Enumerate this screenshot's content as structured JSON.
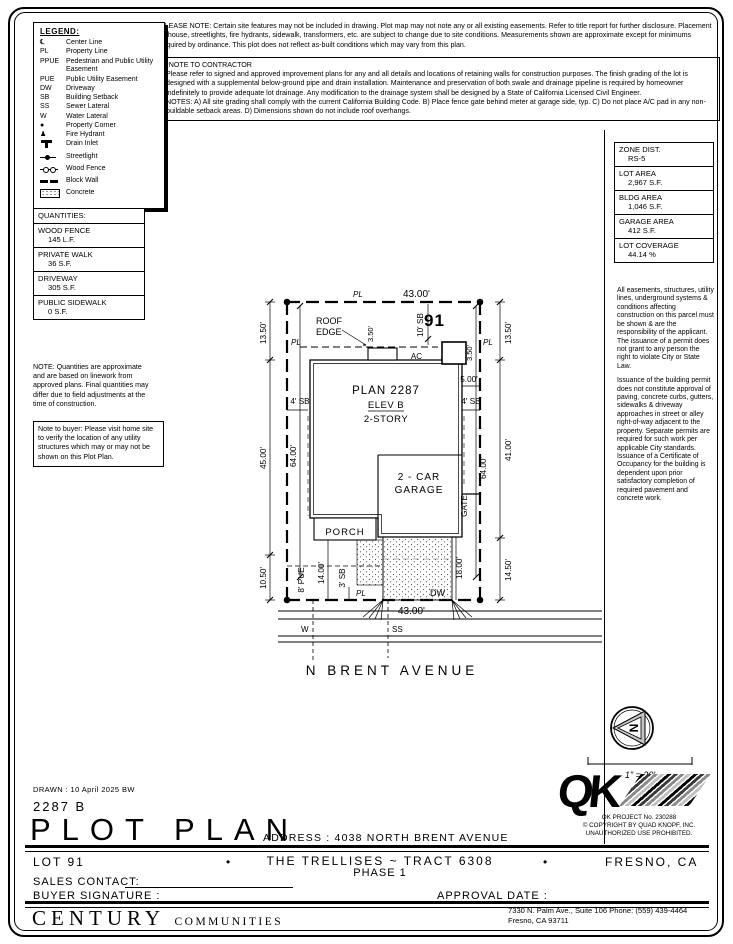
{
  "notes": {
    "please_note": "PLEASE NOTE:  Certain site features may not be included in drawing.  Plot map may not note any or all existing easements.  Refer to title report for further disclosure.  Placement of house, streetlights, fire hydrants, sidewalk, transformers, etc. are subject to change due to site conditions.  Measurements shown are approximate except for minimums required by ordinance.  This plot does not reflect as-built conditions which may vary from this plan.",
    "contractor_title": "*NOTE TO CONTRACTOR",
    "contractor_body": "Please refer to signed and approved improvement plans for any and all details and locations of retaining walls for construction purposes.  The finish grading of the lot is designed with a supplemental below-ground pipe and drain installation.  Maintenance and preservation of both swale and drainage pipeline is required by homeowner indefinitely to provide adequate lot drainage.  Any modification to the drainage system shall be designed by a State of California Licensed Civil Engineer.",
    "contractor_notes": "NOTES:  A) All site grading shall comply with the current California Building Code.  B) Place fence gate behind meter at garage side, typ.  C) Do not place A/C pad in any non-buildable setback areas.  D) Dimensions shown do not include roof overhangs."
  },
  "legend": {
    "title": "LEGEND:",
    "items": [
      {
        "symbol": "℄",
        "label": "Center Line"
      },
      {
        "symbol": "PL",
        "label": "Property Line"
      },
      {
        "symbol": "PPUE",
        "label": "Pedestrian and Public Utility Easement"
      },
      {
        "symbol": "PUE",
        "label": "Public Utility Easement"
      },
      {
        "symbol": "DW",
        "label": "Driveway"
      },
      {
        "symbol": "SB",
        "label": "Building Setback"
      },
      {
        "symbol": "SS",
        "label": "Sewer Lateral"
      },
      {
        "symbol": "W",
        "label": "Water Lateral"
      },
      {
        "symbol": "●",
        "label": "Property Corner"
      },
      {
        "symbol": "♟",
        "label": "Fire Hydrant"
      },
      {
        "symbol": "",
        "label": "Drain Inlet"
      },
      {
        "symbol": "",
        "label": "Streetlight"
      },
      {
        "symbol": "",
        "label": "Wood Fence"
      },
      {
        "symbol": "",
        "label": "Block Wall"
      },
      {
        "symbol": "",
        "label": "Concrete"
      }
    ]
  },
  "quantities": {
    "title": "QUANTITIES:",
    "rows": [
      {
        "label": "WOOD FENCE",
        "value": "145 L.F."
      },
      {
        "label": "PRIVATE WALK",
        "value": "36 S.F."
      },
      {
        "label": "DRIVEWAY",
        "value": "305 S.F."
      },
      {
        "label": "PUBLIC SIDEWALK",
        "value": "0 S.F."
      }
    ],
    "note": "NOTE: Quantities are approximate and are based on linework from approved plans.  Final quantities may differ due to field adjustments at the time of construction.",
    "buyer_note": "Note to buyer: Please visit home site to verify the location of any utility structures which may or may not be shown on this Plot Plan."
  },
  "zoning": {
    "rows": [
      {
        "label": "ZONE DIST.",
        "value": "RS-5"
      },
      {
        "label": "LOT AREA",
        "value": "2,967 S.F."
      },
      {
        "label": "BLDG AREA",
        "value": "1,046 S.F."
      },
      {
        "label": "GARAGE AREA",
        "value": "412 S.F."
      },
      {
        "label": "LOT COVERAGE",
        "value": "44.14 %"
      }
    ],
    "disclaimer1": "All easements, structures, utility lines, underground systems & conditions affecting construction on this parcel must be shown & are the responsibility of the applicant. The issuance of a permit does not grant to any person the right to violate City or State Law.",
    "disclaimer2": "Issuance of the building permit does not constitute approval of paving, concrete curbs, gutters, sidewalks & driveway approaches in street or alley right-of-way adjacent to the property. Separate permits are required for such work per applicable City standards. Issuance of a Certificate of Occupancy for the building is dependent upon prior satisfactory completion of required pavement and concrete work."
  },
  "plan": {
    "lot_number": "91",
    "plan_name": "PLAN 2287",
    "elevation": "ELEV B",
    "stories": "2-STORY",
    "garage_line1": "2 - CAR",
    "garage_line2": "GARAGE",
    "porch_label": "PORCH",
    "roof_line1": "ROOF",
    "roof_line2": "EDGE",
    "ac_label": "AC",
    "gate_label": "GATE",
    "dw_label": "DW",
    "pl_label": "PL",
    "w_label": "W",
    "ss_label": "SS",
    "street_name": "N BRENT AVENUE",
    "north_label": "N",
    "scale_label": "1\" = 20'",
    "dims": {
      "top_width": "43.00'",
      "bottom_width": "43.00'",
      "left_top": "13.50'",
      "left_mid": "45.00'",
      "left_bottom": "10.50'",
      "right_top": "13.50'",
      "right_mid": "41.00'",
      "right_bottom": "14.50'",
      "left_inner": "64.00'",
      "right_inner": "64.00'",
      "front_setback": "10' SB",
      "roof_offset": "3.50'",
      "ac_offset": "3.50'",
      "ac_width": "5.00'",
      "side_setback_left": "4' SB",
      "side_setback_right": "4' SB",
      "pue": "8' PUE",
      "walk_depth": "14.00'",
      "rear_setback": "3' SB",
      "driveway_depth": "18.00'"
    }
  },
  "titleblock": {
    "drawn": "DRAWN : 10 April 2025   BW",
    "plan_number": "2287 B",
    "sheet_title": "PLOT PLAN",
    "address_label": "ADDRESS :",
    "address": "4038 NORTH BRENT AVENUE",
    "lot": "LOT 91",
    "community": "THE TRELLISES ~ TRACT 6308",
    "phase": "PHASE 1",
    "city": "FRESNO, CA",
    "bullet": "•",
    "sales_contact_label": "SALES CONTACT:",
    "buyer_signature_label": "BUYER SIGNATURE :",
    "approval_date_label": "APPROVAL DATE :"
  },
  "footer": {
    "company_primary": "CENTURY",
    "company_secondary": "COMMUNITIES",
    "address_line1": "7330 N. Palm Ave., Suite 106    Phone:  (559) 439-4464",
    "address_line2": "Fresno, CA  93711"
  },
  "qk": {
    "logo_text": "QK",
    "project": "QK PROJECT No. 230288",
    "copyright": "©  COPYRIGHT BY QUAD KNOPF, INC.",
    "notice": "UNAUTHORIZED USE PROHIBITED."
  }
}
